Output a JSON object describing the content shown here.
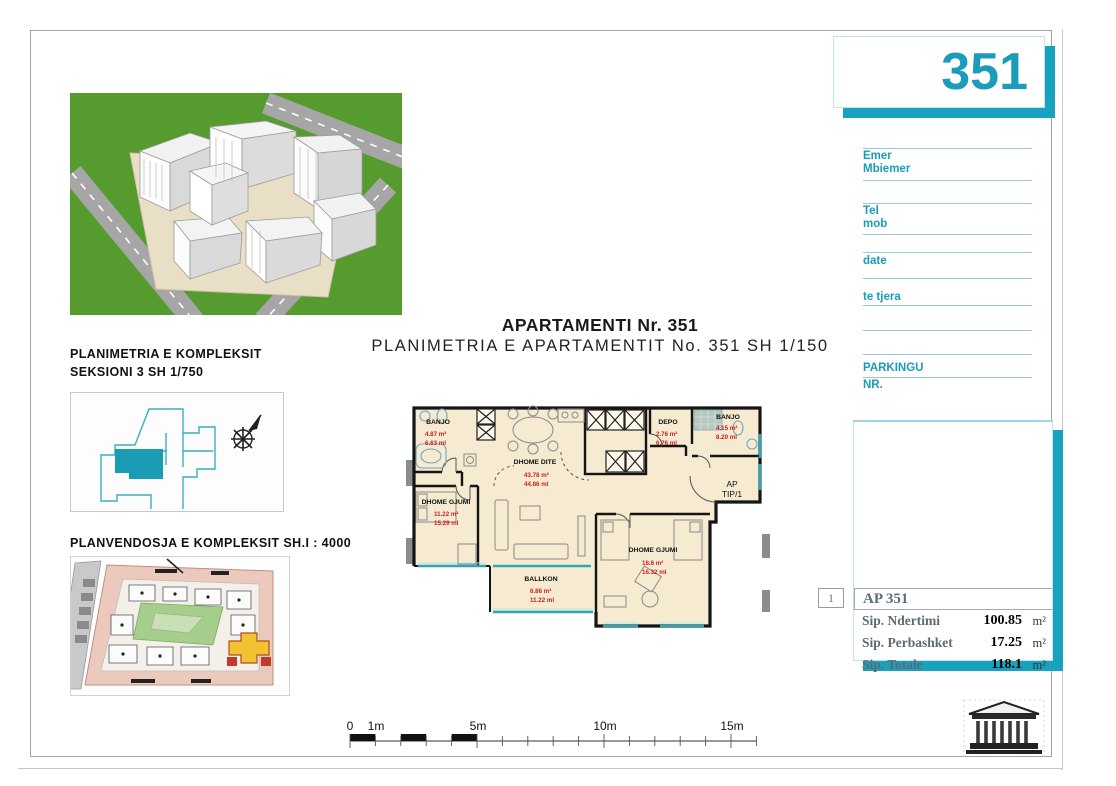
{
  "sheet": {
    "number": "351",
    "title_main": "APARTAMENTI Nr. 351",
    "title_sub": "PLANIMETRIA E APARTAMENTIT No. 351 SH 1/150"
  },
  "left": {
    "komplex_title_1": "PLANIMETRIA E KOMPLEKSIT",
    "komplex_title_2": "SEKSIONI 3  SH 1/750",
    "site_title": "PLANVENDOSJA E KOMPLEKSIT SH.I : 4000"
  },
  "form": {
    "emer": "Emer",
    "mbiemer": "Mbiemer",
    "tel": "Tel",
    "mob": "mob",
    "date": "date",
    "te_tjera": "te tjera",
    "parkingu": "PARKINGU",
    "nr": "NR."
  },
  "plan": {
    "ap_line1": "AP",
    "ap_line2": "TIP/1",
    "rooms": {
      "banjo_tl": {
        "name": "BANJO",
        "area": "4.87 m²",
        "perim": "6.63 ml"
      },
      "gjumi_l": {
        "name": "DHOME GJUMI",
        "area": "11.22 m²",
        "perim": "15.29 ml"
      },
      "dite": {
        "name": "DHOME DITE",
        "area": "43.78 m²",
        "perim": "44.86 ml"
      },
      "depo": {
        "name": "DEPO",
        "area": "2.76 m²",
        "perim": "6.76 ml"
      },
      "banjo_tr": {
        "name": "BANJO",
        "area": "4.15 m²",
        "perim": "8.20 ml"
      },
      "gjumi_br": {
        "name": "DHOME GJUMI",
        "area": "18.6 m²",
        "perim": "16.32 ml"
      },
      "ballkon": {
        "name": "BALLKON",
        "area": "6.86 m²",
        "perim": "11.22 ml"
      }
    }
  },
  "summary": {
    "index": "1",
    "header": "AP 351",
    "rows": [
      {
        "label": "Sip. Ndertimi",
        "value": "100.85",
        "unit": "m²"
      },
      {
        "label": "Sip. Perbashket",
        "value": "17.25",
        "unit": "m²"
      },
      {
        "label": "Sip. Totale",
        "value": "118.1",
        "unit": "m²"
      }
    ]
  },
  "scalebar": {
    "l0": "0",
    "l1": "1m",
    "l5": "5m",
    "l10": "10m",
    "l15": "15m"
  },
  "colors": {
    "teal": "#18a2bd",
    "teal_text": "#1a9cba",
    "plan_cream": "#f6ead0",
    "plan_red": "#cc2020",
    "site_green": "#a5cd8c",
    "site_yellow": "#f1c232",
    "render_green": "#569b2e"
  }
}
